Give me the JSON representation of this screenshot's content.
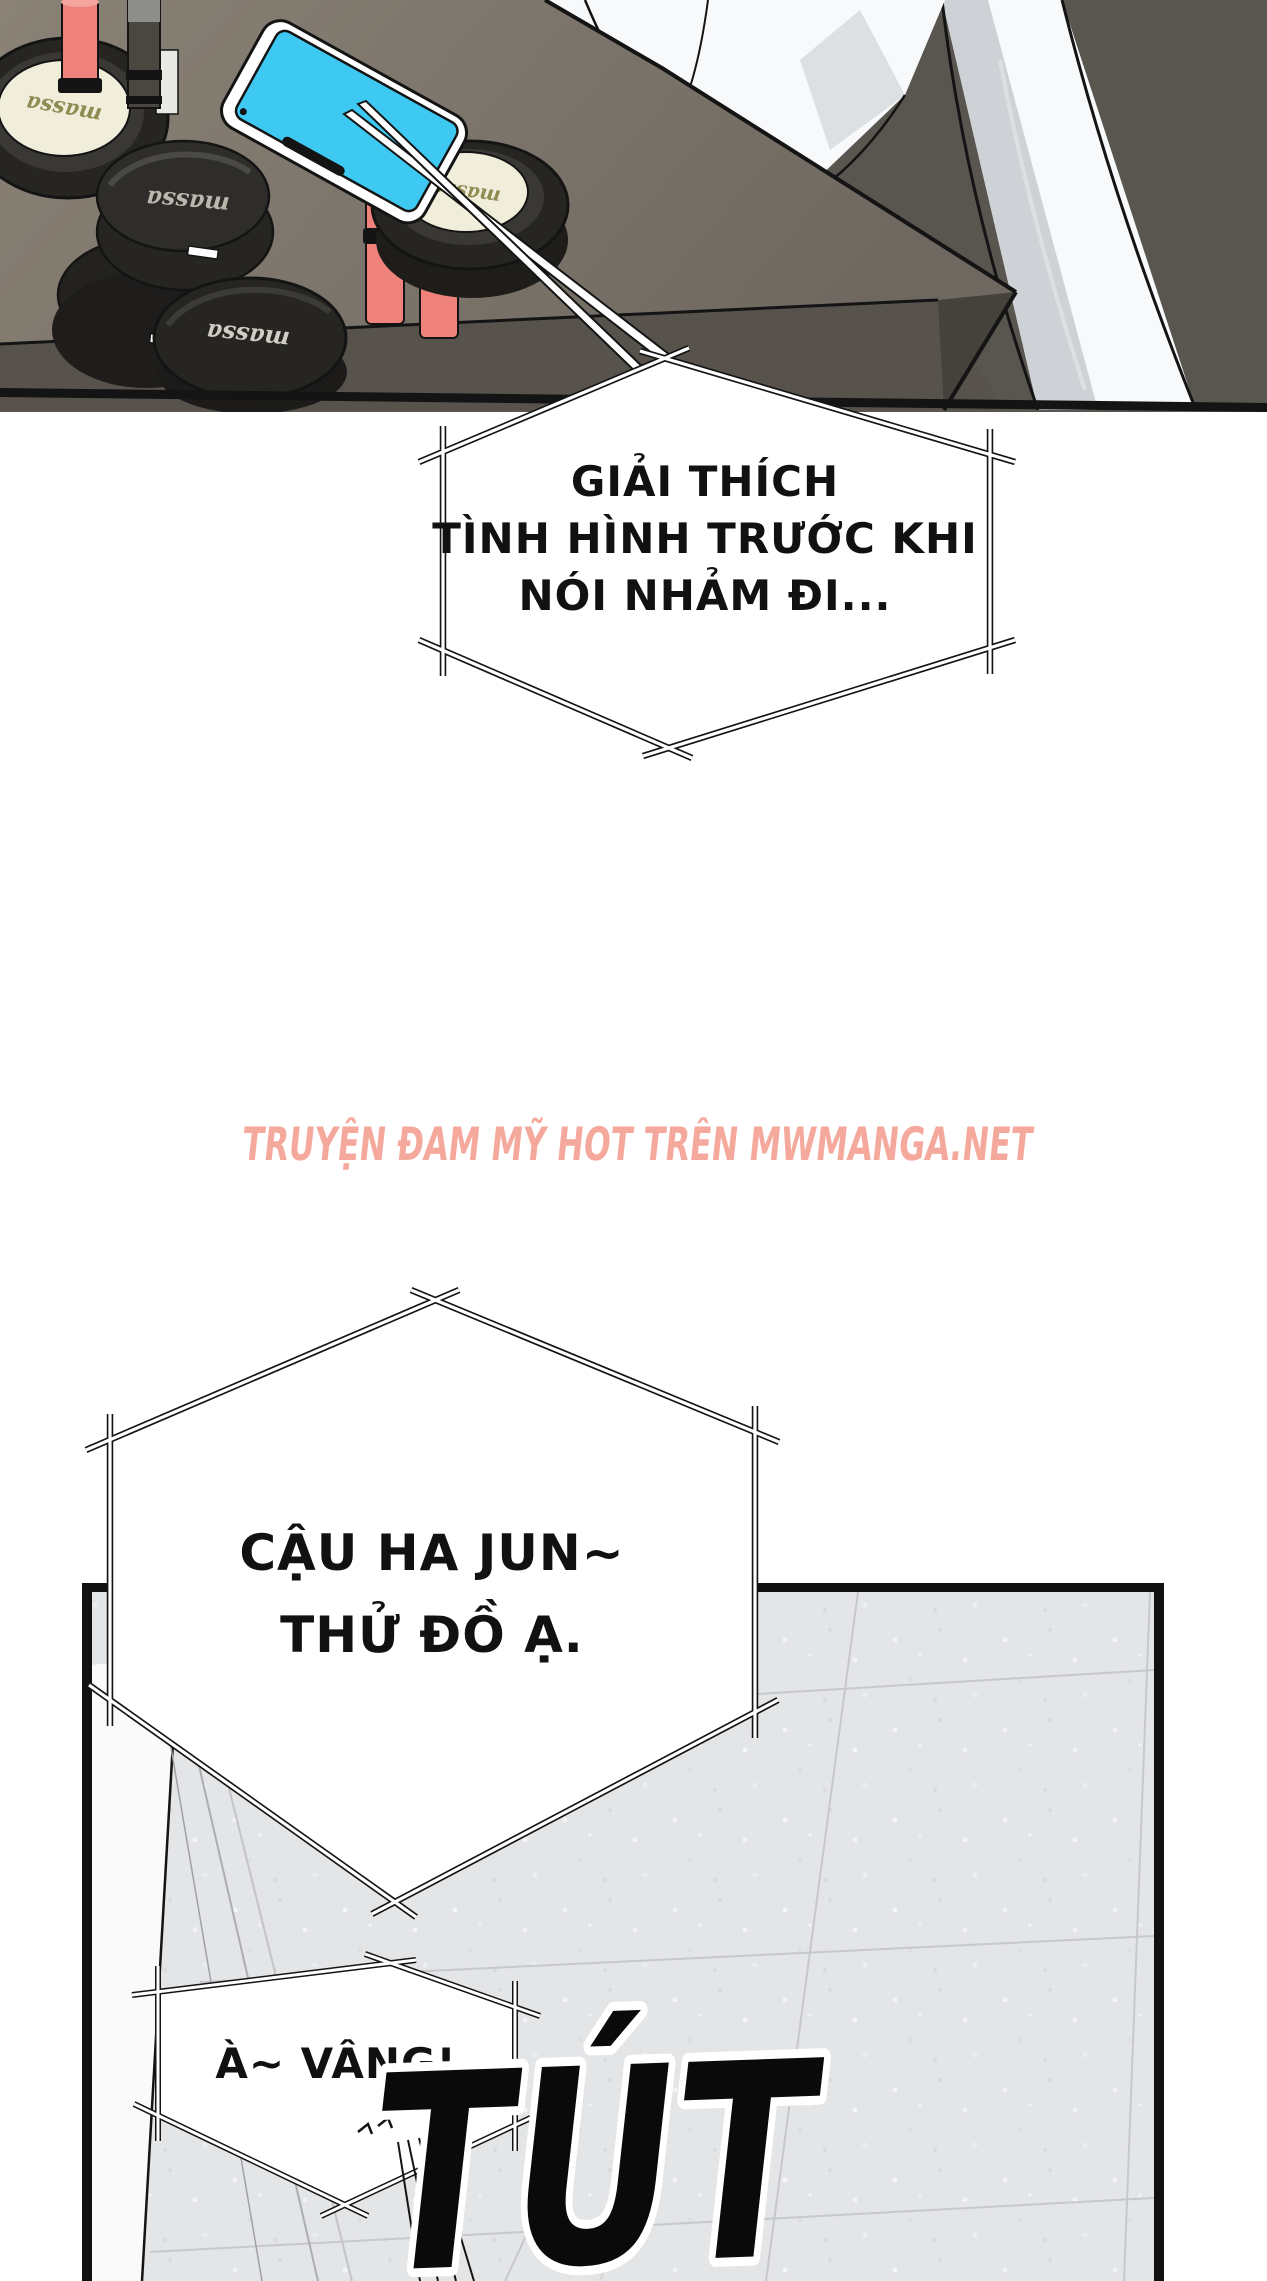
{
  "comic": {
    "brand_label": "massa",
    "bubbles": [
      {
        "name": "bubble-1",
        "lines": [
          "GIẢI THÍCH",
          "TÌNH HÌNH TRƯỚC KHI",
          "NÓI NHẢM ĐI..."
        ]
      },
      {
        "name": "bubble-2",
        "lines": [
          "CẬU HA JUN~",
          "THỬ ĐỒ Ạ."
        ]
      },
      {
        "name": "bubble-3",
        "lines": [
          "À~ VÂNG!"
        ]
      }
    ],
    "sfx": {
      "text": "TÚT"
    },
    "watermark": {
      "text": "TRUYỆN ĐAM MỸ HOT TRÊN MWMANGA.NET",
      "color": "#F5A99C"
    },
    "colors": {
      "wall": "#59554F",
      "table_top_light": "#8A8276",
      "table_top_dark": "#6E6860",
      "table_front": "#57524B",
      "table_corner": "#45413B",
      "cloth": "#F8F9FA",
      "cloth_shadow": "#CED2D6",
      "phone_screen": "#3EC9F3",
      "lipstick": "#EF837C",
      "lipstick_top": "#F6A29B",
      "pad": "#F0EDDA",
      "brand_olive": "#8F8C53",
      "compact_black": "#262522",
      "floor": "#E4E5E7",
      "floor_seam": "#C6C8CB",
      "outline": "#141414"
    }
  }
}
